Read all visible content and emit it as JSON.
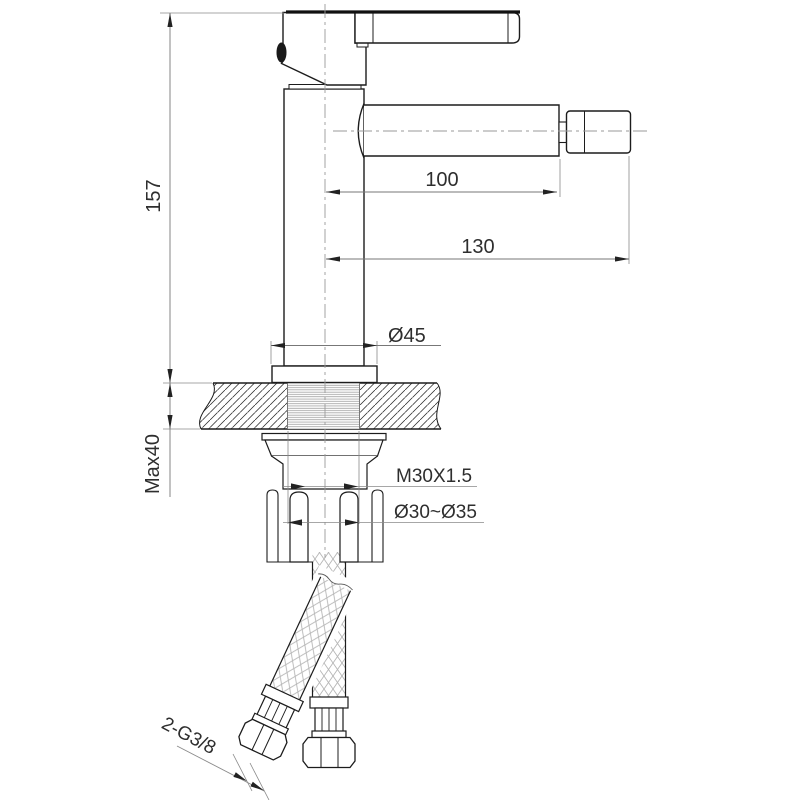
{
  "drawing": {
    "type": "faucet-installation-technical-drawing",
    "dimensions": {
      "height": "157",
      "spout_reach": "100",
      "overall_reach": "130",
      "flange_diameter": "Ø45",
      "max_deck_thickness": "Max40",
      "shank_thread": "M30X1.5",
      "hole_diameter": "Ø30~Ø35",
      "hose_connection": "2-G3/8"
    },
    "colors": {
      "object_line": "#1c1c1c",
      "thin_line": "#8a8a8a",
      "centerline": "#9a9a9a",
      "text": "#2e2e2e",
      "background": "#ffffff"
    }
  }
}
